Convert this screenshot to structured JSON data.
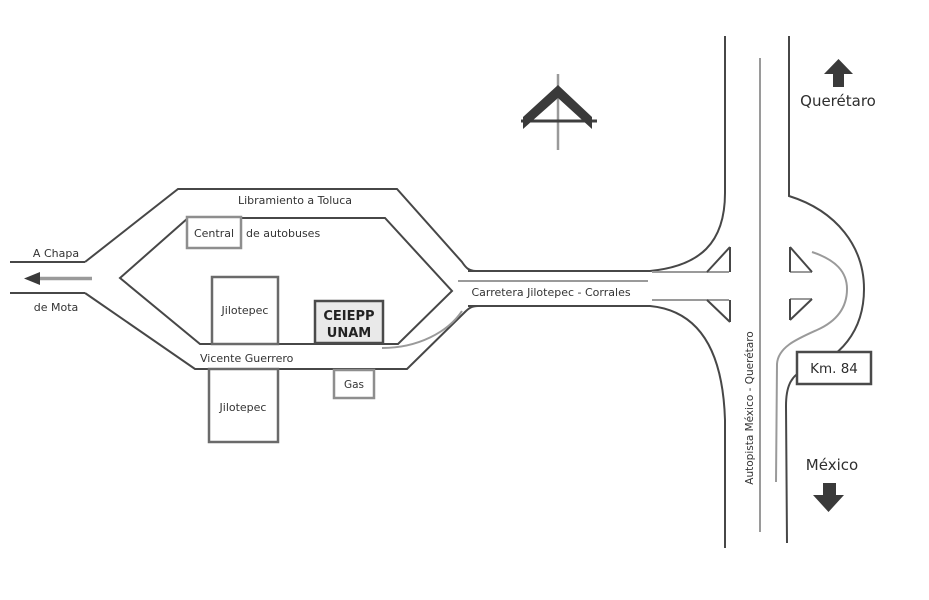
{
  "map": {
    "destinations": {
      "north": "Querétaro",
      "south": "México",
      "west_line1": "A Chapa",
      "west_line2": "de Mota"
    },
    "roads": {
      "loop": "Libramiento a Toluca",
      "south_street": "Vicente Guerrero",
      "east_west_road": "Carretera Jilotepec - Corrales",
      "highway": "Autopista México - Querétaro"
    },
    "places": {
      "bus_station_word_boxed": "Central",
      "bus_station_word_rest": "de autobuses",
      "town_block_upper": "Jilotepec",
      "town_block_lower": "Jilotepec",
      "venue_line1": "CEIEPP",
      "venue_line2": "UNAM",
      "gas_station": "Gas",
      "km_marker": "Km. 84"
    },
    "colors": {
      "road_dark": "#474747",
      "road_light": "#9a9a9a",
      "text": "#333333",
      "arrow_fill": "#3a3a3a",
      "venue_box_fill": "#e9e9e9",
      "background": "#ffffff"
    }
  }
}
